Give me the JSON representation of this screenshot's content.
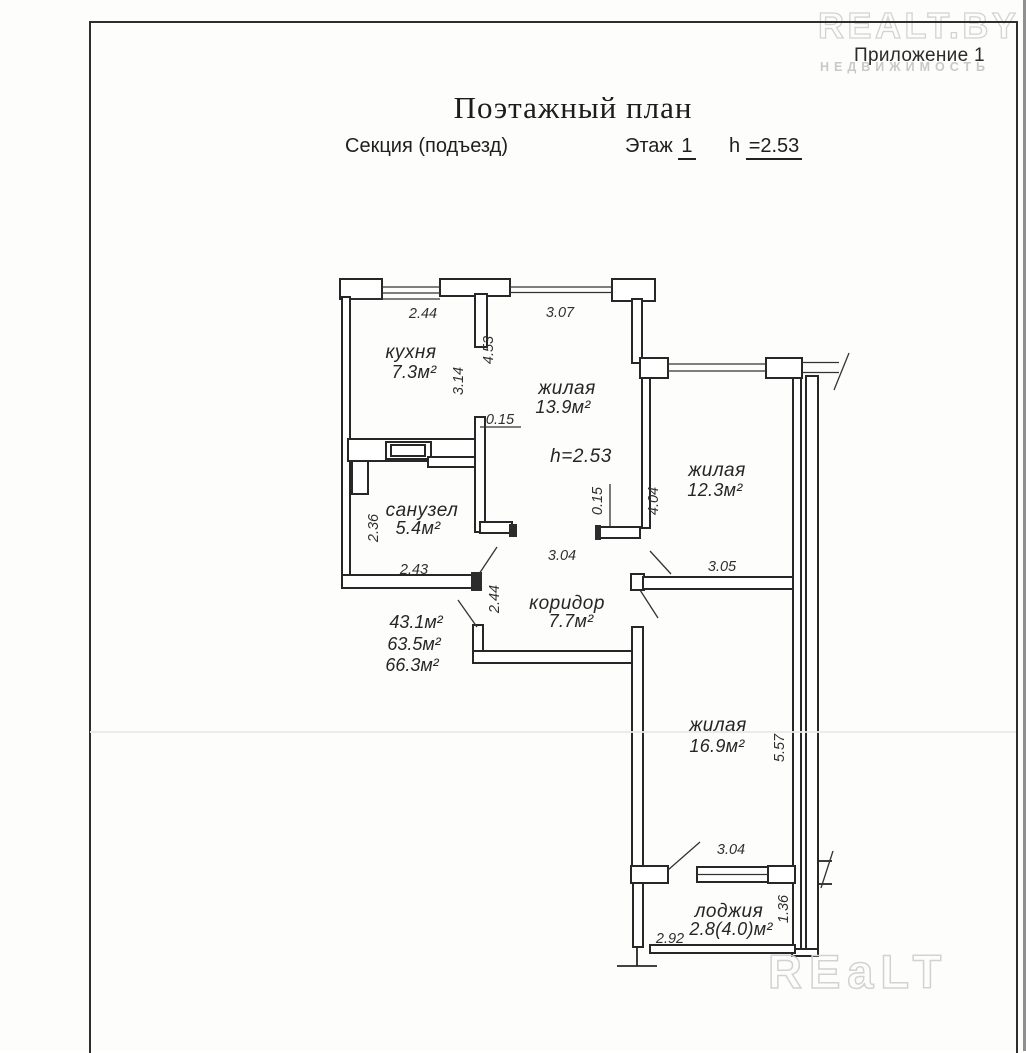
{
  "watermarks": {
    "top_brand": "REALT.BY",
    "top_sub": "НЕДВИЖИМОСТЬ",
    "bottom_brand": "REaLT"
  },
  "header": {
    "annex": "Приложение 1",
    "title": "Поэтажный план",
    "section_label": "Секция (подъезд)",
    "floor_label": "Этаж",
    "floor_value": "1",
    "height_label": "h",
    "height_value": "=2.53"
  },
  "plan": {
    "ceiling_note": "h=2.53",
    "rooms": {
      "kitchen": {
        "name": "кухня",
        "area": "7.3м²"
      },
      "living1": {
        "name": "жилая",
        "area": "13.9м²"
      },
      "bathroom": {
        "name": "санузел",
        "area": "5.4м²"
      },
      "living2": {
        "name": "жилая",
        "area": "12.3м²"
      },
      "corridor": {
        "name": "коридор",
        "area": "7.7м²"
      },
      "living3": {
        "name": "жилая",
        "area": "16.9м²"
      },
      "loggia": {
        "name": "лоджия",
        "area": "2.8(4.0)м²"
      }
    },
    "area_summary": {
      "living_total": "43.1м²",
      "apartment_total": "63.5м²",
      "total_with_loggia": "66.3м²"
    },
    "dimensions": {
      "kitchen_window_width": "2.44",
      "living1_window_width": "3.07",
      "living1_depth": "4.53",
      "kitchen_depth": "3.14",
      "wall_thickness_left": "0.15",
      "bathroom_depth": "2.36",
      "bathroom_width": "2.43",
      "corridor_length": "2.44",
      "corridor_width": "3.04",
      "wall_thickness_right": "0.15",
      "living2_depth": "4.04",
      "living2_width": "3.05",
      "living3_depth": "5.57",
      "living3_width": "3.04",
      "loggia_depth": "1.36",
      "loggia_width": "2.92"
    }
  }
}
